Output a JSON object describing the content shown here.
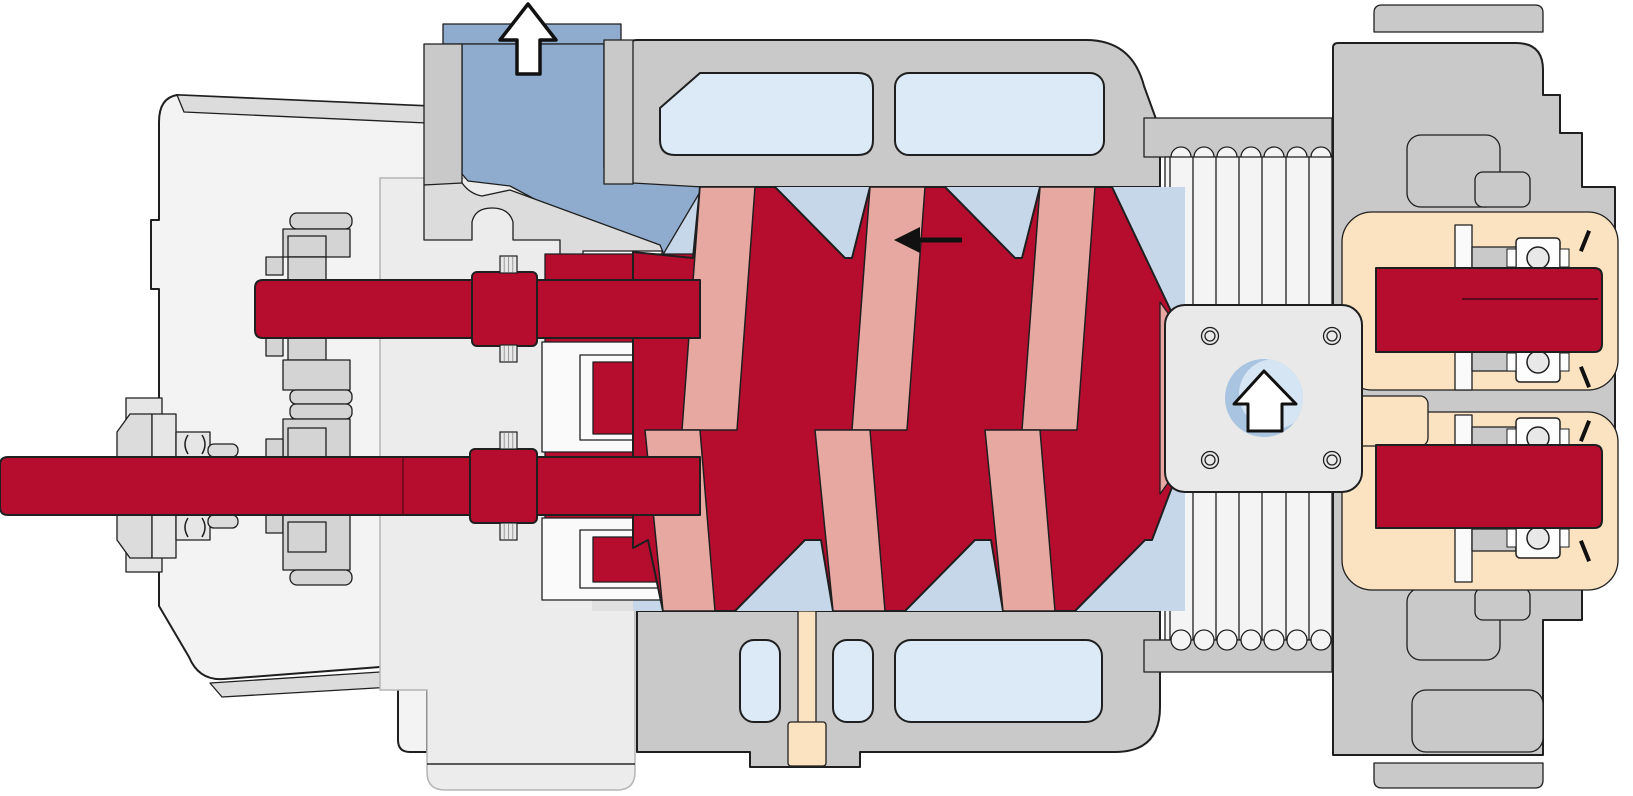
{
  "diagram": {
    "title": "Twin-screw compressor cross-section",
    "type": "technical-cutaway",
    "arrows": {
      "discharge": {
        "direction": "up",
        "meaning": "gas discharge outlet",
        "style": "white-outlined"
      },
      "suction": {
        "direction": "up",
        "meaning": "gas suction inlet",
        "style": "white-outlined-in-circle"
      },
      "flow": {
        "direction": "left",
        "meaning": "gas flow along rotors",
        "style": "solid-black"
      }
    },
    "palette": {
      "line": "#1f1f1f",
      "casing": "#c9c9c9",
      "casing_dark": "#c2c2c2",
      "wall": "#dcdcdc",
      "cover": "#f3f3f3",
      "panel": "#ececec",
      "panel_shadow": "#e0e0e0",
      "chamber_blue": "#c7d7ea",
      "duct_blue": "#8fabcd",
      "window_blue": "#dce9f6",
      "port_blue": "#d6e5f3",
      "port_blue_dark": "#a9c4e0",
      "rotor_red": "#b60d2f",
      "rotor_pink": "#e8a8a2",
      "oil_cream": "#fbe3c1",
      "fin": "#f4f4f4",
      "gear_gray": "#d4d4d4",
      "seal_gray": "#e6e6e6",
      "bearing_white": "#fdfdfd",
      "bearing_circle": "#e8e8e8"
    },
    "components": [
      "gear-cover",
      "oil-sump-panel",
      "timing-gears",
      "drive-shaft",
      "rotor-shaft",
      "shaft-seal",
      "discharge-port",
      "casing-top",
      "casing-bottom",
      "cooling-windows",
      "screw-rotors",
      "drain-plug",
      "cooling-fins",
      "suction-flange",
      "suction-port",
      "bearing-housing",
      "ball-bearings",
      "oil-chambers"
    ],
    "fins": {
      "count": 7,
      "line_xs": [
        1170,
        1193,
        1216,
        1239,
        1262,
        1286,
        1309
      ]
    },
    "scallops": {
      "count": 7,
      "cup_xs": [
        1181,
        1204,
        1227,
        1251,
        1274,
        1297,
        1321
      ],
      "top_y": 157,
      "bottom_y": 640,
      "radius": 10
    },
    "bearings": {
      "centers_y": [
        258,
        362,
        438,
        538
      ],
      "x": 1516,
      "width": 44,
      "height": 40,
      "circle_r": 11,
      "circle_x": 1538
    },
    "rotor_pattern": {
      "upper_bands": [
        [
          700,
          187,
          755,
          187,
          737,
          430,
          682,
          430
        ],
        [
          870,
          187,
          925,
          187,
          907,
          430,
          852,
          430
        ],
        [
          1040,
          187,
          1095,
          187,
          1077,
          430,
          1022,
          430
        ]
      ],
      "lower_bands": [
        [
          645,
          430,
          700,
          430,
          715,
          611,
          663,
          611
        ],
        [
          815,
          430,
          870,
          430,
          885,
          611,
          833,
          611
        ],
        [
          985,
          430,
          1040,
          430,
          1055,
          611,
          1003,
          611
        ]
      ]
    }
  }
}
